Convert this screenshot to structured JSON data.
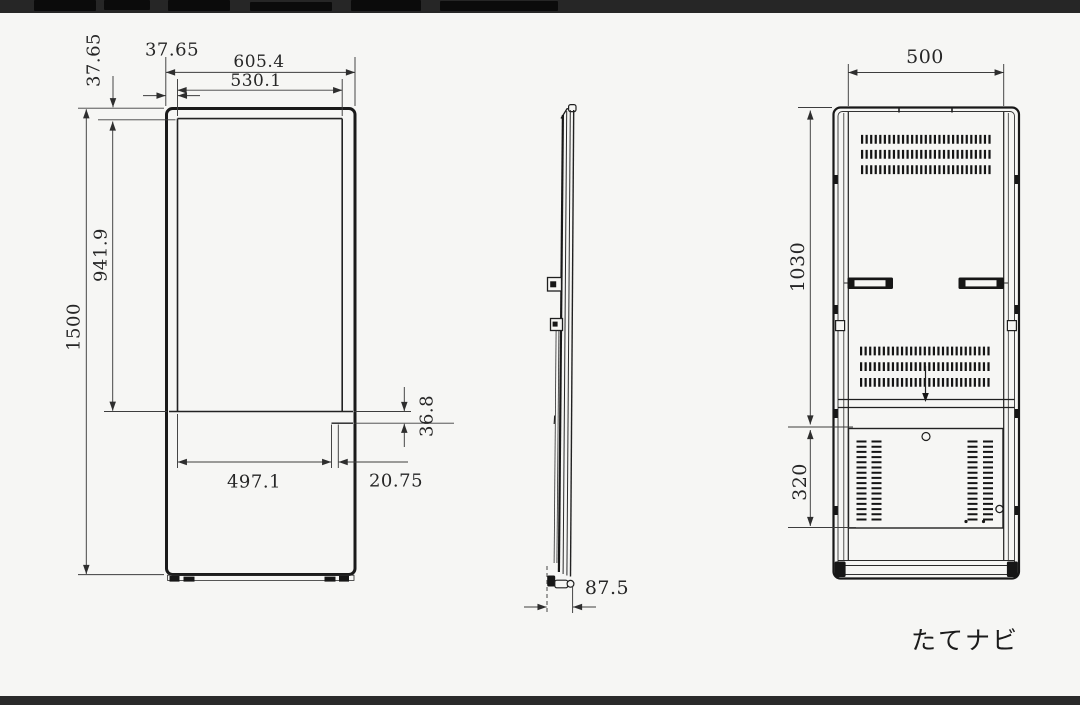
{
  "front_view": {
    "outer_width": "605.4",
    "screen_width": "530.1",
    "side_bezel": "37.65",
    "top_bezel": "37.65",
    "total_height": "1500",
    "screen_height": "941.9",
    "lower_strip_height": "36.8",
    "lower_width": "497.1",
    "lower_offset": "20.75"
  },
  "side_view": {
    "depth": "87.5"
  },
  "rear_view": {
    "width": "500",
    "upper_height": "1030",
    "lower_panel_height": "320"
  },
  "caption": "たてナビ"
}
